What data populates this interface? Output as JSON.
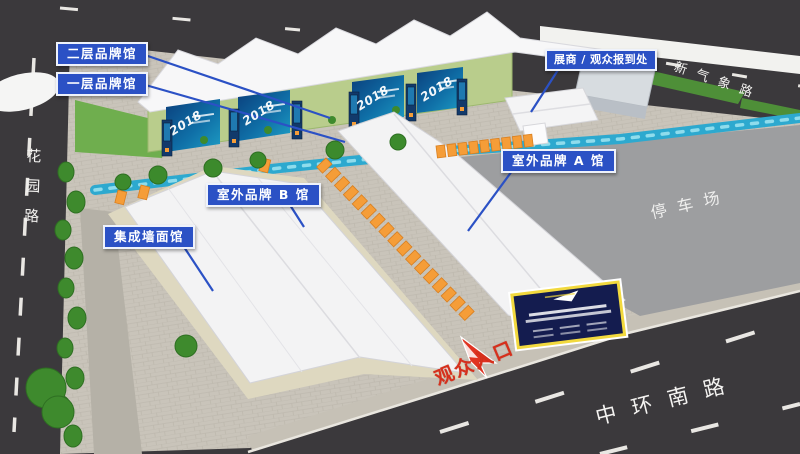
{
  "callouts": {
    "second_floor_hall": "二层品牌馆",
    "first_floor_hall": "一层品牌馆",
    "checkin": "展商 / 观众报到处",
    "outdoor_hall_b": "室外品牌 B 馆",
    "outdoor_hall_a": "室外品牌 A 馆",
    "wall_hall": "集成墙面馆"
  },
  "roads": {
    "west": "花园路",
    "north": "新气象路",
    "south": "中环南路"
  },
  "areas": {
    "parking": "停车场"
  },
  "entrance": {
    "label": "观众入口"
  },
  "banners": {
    "year": "2018"
  },
  "colors": {
    "callout_blue": "#2b51c5",
    "road_dark": "#3b393c",
    "pavement": "#c9c4ba",
    "parking_gray": "#9d9ea0",
    "water_blue": "#2da9cf",
    "booth_orange": "#f59d38",
    "tent_white": "#f4f4f5",
    "lawn_green": "#6fae4e",
    "billboard_navy": "#141c4f",
    "billboard_trim": "#f2d93e",
    "entrance_red": "#d6301c",
    "banner_blue": "#0b3f7c"
  }
}
